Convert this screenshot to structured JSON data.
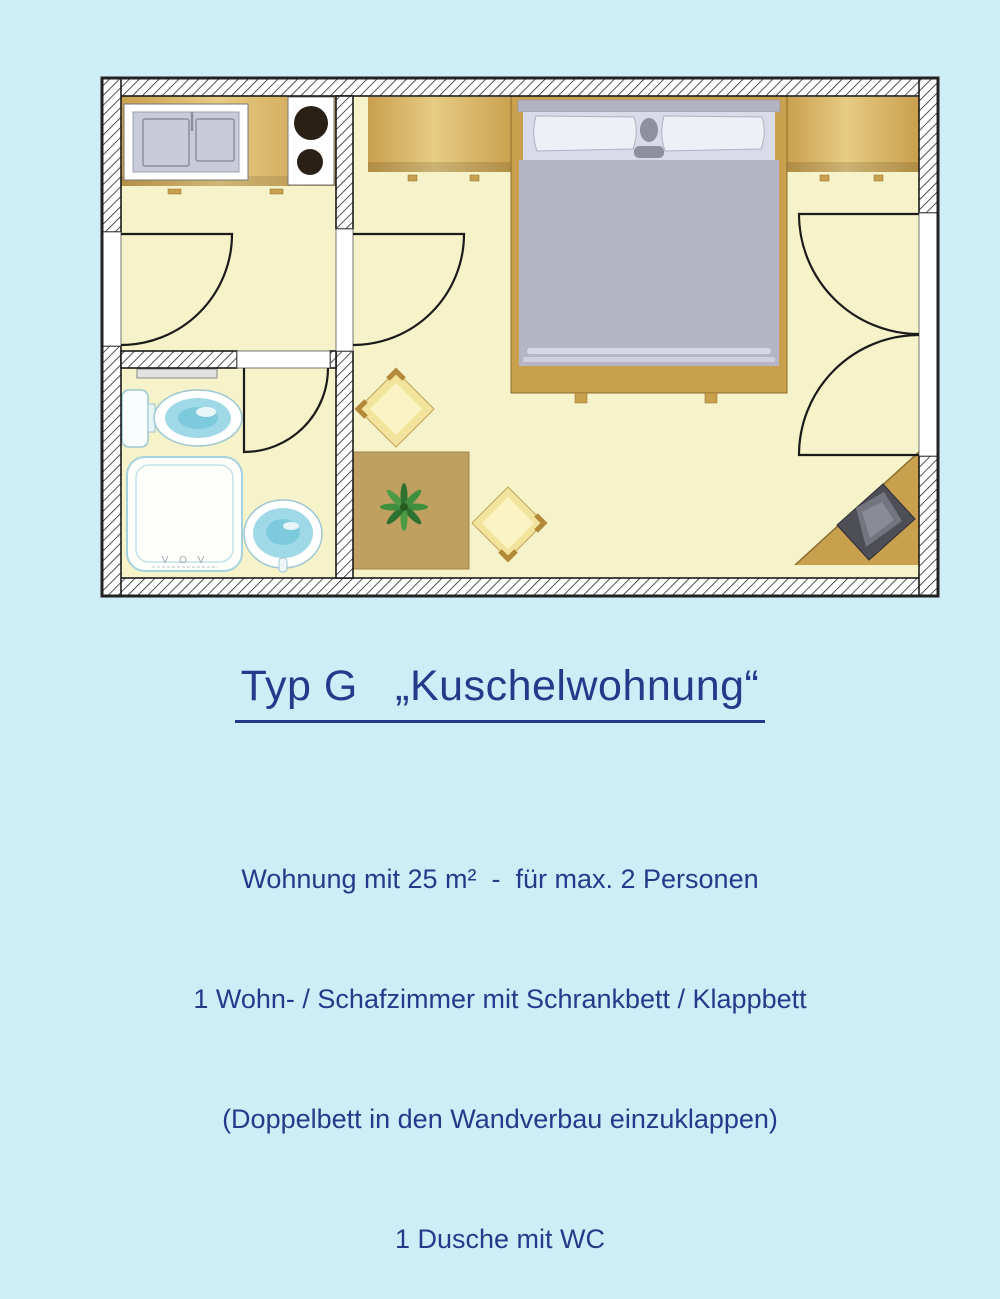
{
  "title": {
    "text": "Typ G   „Kuschelwohnung“"
  },
  "description": {
    "lines": [
      "Wohnung mit 25 m²  -  für max. 2 Personen",
      "1 Wohn- / Schafzimmer mit Schrankbett / Klappbett",
      "(Doppelbett in den Wandverbau einzuklappen)",
      "1 Dusche mit WC"
    ]
  },
  "floor_plan": {
    "shower_mark": "V O V",
    "elements": [
      "entry-door",
      "living-room-door",
      "bathroom-door",
      "double-door",
      "kitchenette-sink",
      "stove",
      "toilet",
      "shower",
      "washbasin",
      "towel-rail",
      "double-bed",
      "pillows",
      "wardrobe-left",
      "wardrobe-right",
      "dining-table",
      "plant",
      "chair",
      "armchair",
      "corner-unit"
    ],
    "colors": {
      "background": "#cdeef7",
      "text": "#27398a",
      "floor": "#f6f2c9",
      "wall_line": "#1b1b1b",
      "wood": "#c9a04e",
      "wood_dark": "#8a6d2f",
      "table": "#bfa061",
      "bed_duvet": "#b5b5c5",
      "bed_linen": "#eef0f8",
      "fixture_blue": "#9fd8e6",
      "chair": "#f2e49c",
      "armchair": "#4e4e56",
      "plant": "#3f8f3f"
    }
  }
}
